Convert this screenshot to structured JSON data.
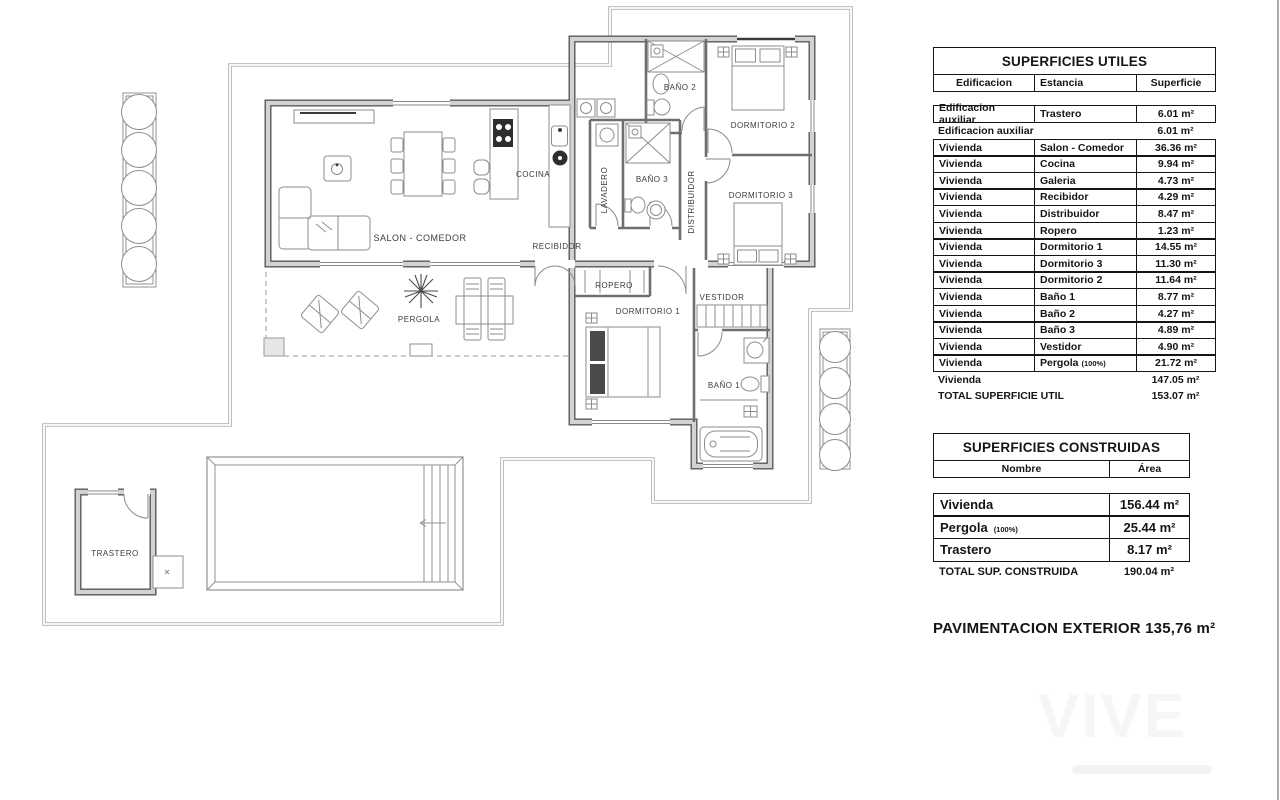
{
  "plan": {
    "labels": {
      "salon": "SALON - COMEDOR",
      "cocina": "COCINA",
      "lavadero": "LAVADERO",
      "bano3": "BAÑO 3",
      "distribuidor": "DISTRIBUIDOR",
      "bano2": "BAÑO 2",
      "dormitorio2": "DORMITORIO 2",
      "dormitorio3": "DORMITORIO 3",
      "recibidor": "RECIBIDOR",
      "ropero": "ROPERO",
      "dormitorio1": "DORMITORIO 1",
      "vestidor": "VESTIDOR",
      "bano1": "BAÑO 1",
      "pergola": "PERGOLA",
      "trastero": "TRASTERO"
    }
  },
  "tables": {
    "utiles": {
      "title": "SUPERFICIES UTILES",
      "headers": [
        "Edificacion",
        "Estancia",
        "Superficie"
      ],
      "rows": [
        {
          "e": "Edificacion auxiliar",
          "s": "Trastero",
          "v": "6.01 m²"
        },
        {
          "e": "Edificacion auxiliar",
          "v": "6.01 m²"
        },
        {
          "e": "Vivienda",
          "s": "Salon - Comedor",
          "v": "36.36 m²"
        },
        {
          "e": "Vivienda",
          "s": "Cocina",
          "v": "9.94 m²"
        },
        {
          "e": "Vivienda",
          "s": "Galeria",
          "v": "4.73 m²"
        },
        {
          "e": "Vivienda",
          "s": "Recibidor",
          "v": "4.29 m²"
        },
        {
          "e": "Vivienda",
          "s": "Distribuidor",
          "v": "8.47 m²"
        },
        {
          "e": "Vivienda",
          "s": "Ropero",
          "v": "1.23 m²"
        },
        {
          "e": "Vivienda",
          "s": "Dormitorio 1",
          "v": "14.55 m²"
        },
        {
          "e": "Vivienda",
          "s": "Dormitorio 3",
          "v": "11.30 m²"
        },
        {
          "e": "Vivienda",
          "s": "Dormitorio 2",
          "v": "11.64 m²"
        },
        {
          "e": "Vivienda",
          "s": "Baño 1",
          "v": "8.77 m²"
        },
        {
          "e": "Vivienda",
          "s": "Baño 2",
          "v": "4.27 m²"
        },
        {
          "e": "Vivienda",
          "s": "Baño 3",
          "v": "4.89 m²"
        },
        {
          "e": "Vivienda",
          "s": "Vestidor",
          "v": "4.90 m²"
        },
        {
          "e": "Vivienda",
          "s": "Pergola",
          "n": "(100%)",
          "v": "21.72 m²"
        },
        {
          "e": "Vivienda",
          "v": "147.05 m²"
        },
        {
          "e": "TOTAL SUPERFICIE UTIL",
          "v": "153.07 m²"
        }
      ]
    },
    "construidas": {
      "title": "SUPERFICIES CONSTRUIDAS",
      "headers": [
        "Nombre",
        "Área"
      ],
      "rows": [
        {
          "name": "Vivienda",
          "v": "156.44 m²"
        },
        {
          "name": "Pergola",
          "n": "(100%)",
          "v": "25.44 m²"
        },
        {
          "name": "Trastero",
          "v": "8.17 m²"
        }
      ],
      "total": {
        "name": "TOTAL SUP. CONSTRUIDA",
        "v": "190.04 m²"
      }
    }
  },
  "footer": {
    "pavimentacion": "PAVIMENTACION EXTERIOR 135,76 m²"
  },
  "watermark": {
    "text": "VIVE"
  },
  "colors": {
    "line_dark": "#5a5a5a",
    "line_light": "#b0b0b0",
    "text": "#151515"
  }
}
